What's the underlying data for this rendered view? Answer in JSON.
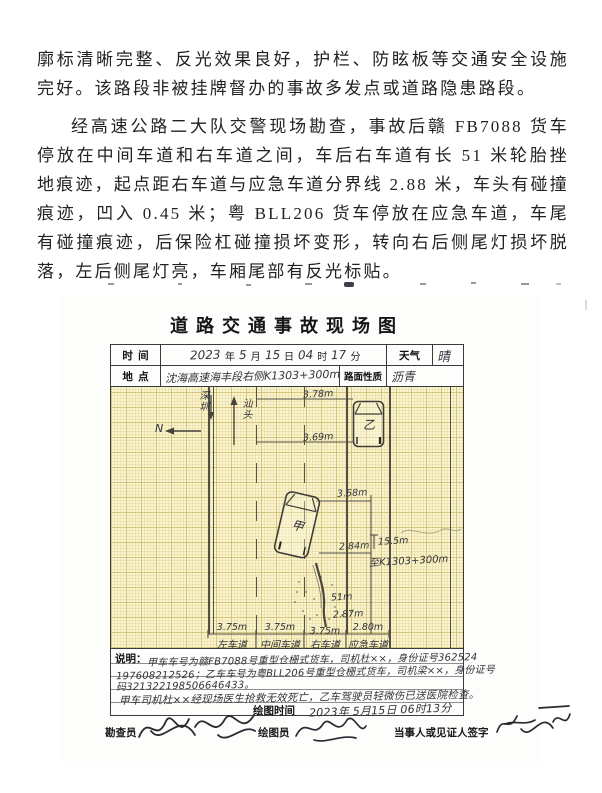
{
  "document": {
    "paragraph1": "廓标清晰完整、反光效果良好，护栏、防眩板等交通安全设施完好。该路段非被挂牌督办的事故多发点或道路隐患路段。",
    "paragraph2": "经高速公路二大队交警现场勘查，事故后赣 FB7088 货车停放在中间车道和右车道之间，车后右车道有长 51 米轮胎挫地痕迹，起点距右车道与应急车道分界线 2.88 米，车头有碰撞痕迹，凹入 0.45 米；粤 BLL206 货车停放在应急车道，车尾有碰撞痕迹，后保险杠碰撞损坏变形，转向右后侧尾灯损坏脱落，左后侧尾灯亮，车厢尾部有反光标贴。"
  },
  "form": {
    "title": "道路交通事故现场图",
    "header": {
      "time_label": "时  间",
      "time": {
        "year": "2023",
        "month": "5",
        "day": "15",
        "hour": "04",
        "minute": "17"
      },
      "time_units": {
        "year": "年",
        "month": "月",
        "day": "日",
        "hour": "时",
        "minute": "分"
      },
      "weather_label": "天气",
      "weather_value": "晴",
      "location_label": "地  点",
      "location_value": "沈海高速海丰段右侧K1303+300m",
      "surface_label": "路面性质",
      "surface_value": "沥青"
    },
    "diagram": {
      "direction_down_label": "深圳",
      "compass_letter": "N",
      "direction_up_label": "汕头",
      "vehicle_a": "甲",
      "vehicle_b": "乙",
      "m_378": "3.78m",
      "m_369": "3.69m",
      "m_358": "3.58m",
      "m_284": "2.84m",
      "m_skid": "51m",
      "m_287": "2.87m",
      "m_155": "15.5m",
      "stake_note": "至K1303+300m",
      "lane_widths": [
        "3.75m",
        "3.75m",
        "3.75m",
        "2.80m"
      ],
      "lane_names": [
        "左车道",
        "中间车道",
        "右车道",
        "应急车道"
      ]
    },
    "explain": {
      "label": "说明：",
      "lines": [
        "甲车车号为赣FB7088号重型仓栅式货车，司机杜××，身份证号362524",
        "197608212526；乙车车号为粤BLL206号重型仓栅式货车，司机梁××，身份证号",
        "码321322198506646433。",
        "甲车司机杜××经现场医生抢救无效死亡，乙车驾驶员轻微伤已送医院检查。"
      ],
      "draw_time_label": "绘图时间",
      "draw_time_value": "2023年 5月15日 06时13分"
    },
    "signatures": {
      "surveyor_label": "勘查员",
      "drafter_label": "绘图员",
      "party_label": "当事人或见证人签字"
    }
  }
}
